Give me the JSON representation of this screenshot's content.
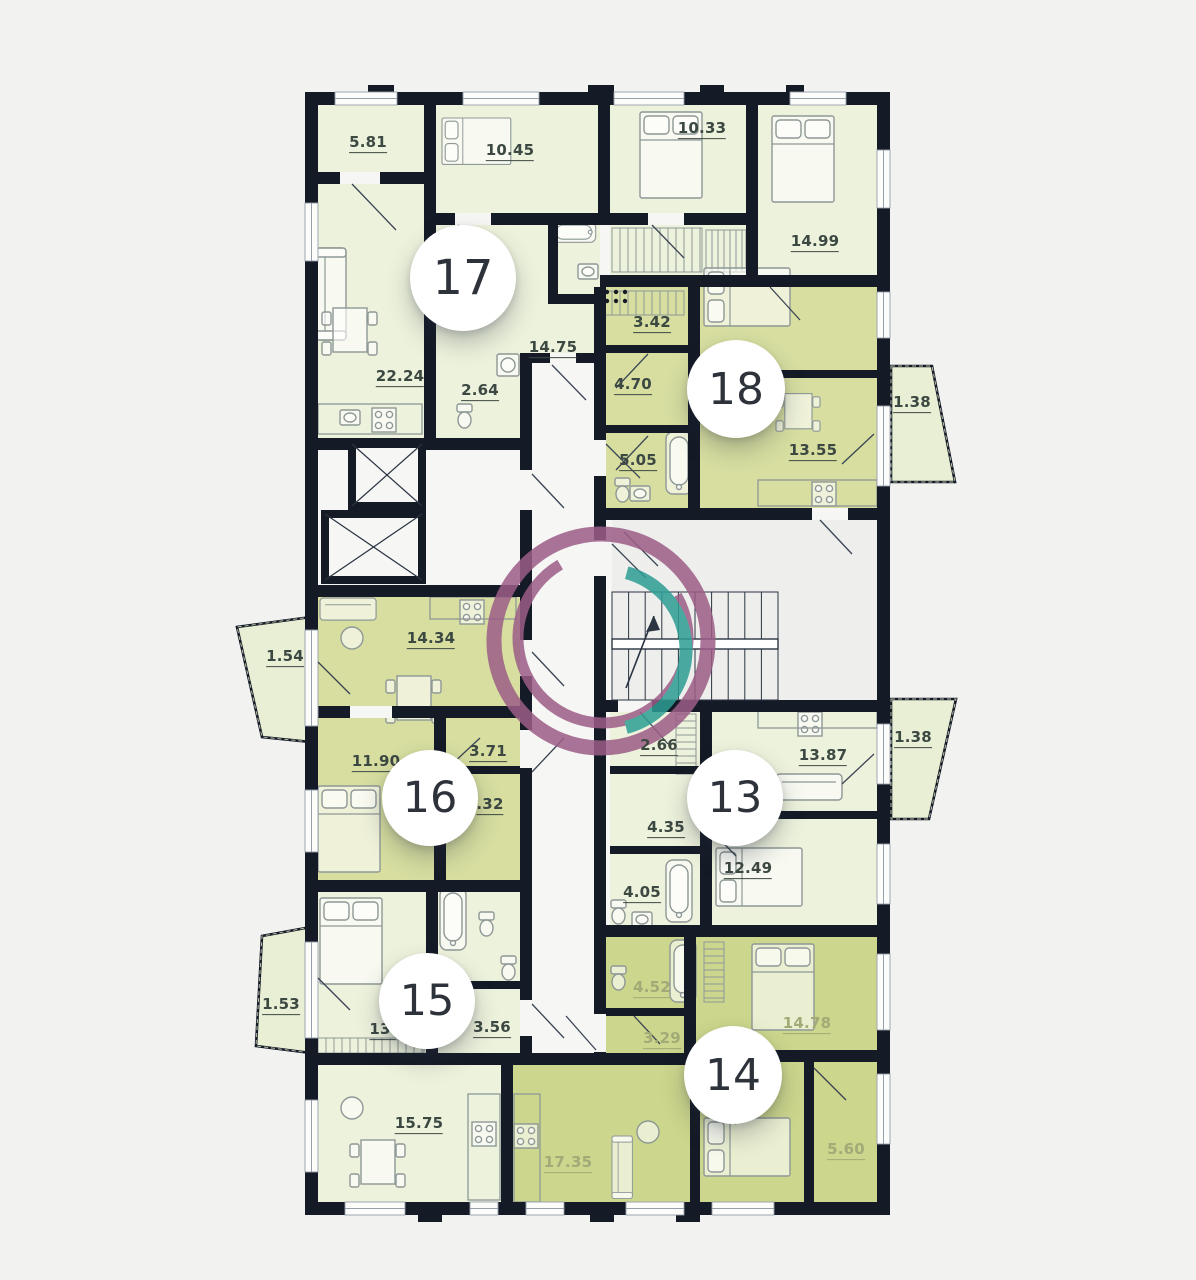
{
  "palette": {
    "background": "#f2f2f1",
    "wall": "#141a26",
    "room_light": "#edf2dc",
    "room_green": "#d7dea0",
    "room_green_deep": "#ccd68c",
    "balcony": "#e9efd5",
    "corridor": "#f6f6f4",
    "stair_core": "#eeeeec",
    "furniture_stroke": "#8e9896",
    "door_stroke": "#3a4454",
    "window_stroke": "#96a0ab",
    "label_dark": "#3c4842",
    "label_light": "#a2aa77",
    "circle_text": "#2e333b",
    "logo_purple": "#9c5d87",
    "logo_teal": "#2d9e94"
  },
  "floor_plan": {
    "apartments": [
      {
        "number": "17",
        "circle_x": 463,
        "circle_y": 278,
        "circle_size": 106
      },
      {
        "number": "18",
        "circle_x": 736,
        "circle_y": 389,
        "circle_size": 98
      },
      {
        "number": "16",
        "circle_x": 430,
        "circle_y": 798,
        "circle_size": 96
      },
      {
        "number": "13",
        "circle_x": 735,
        "circle_y": 798,
        "circle_size": 96
      },
      {
        "number": "15",
        "circle_x": 427,
        "circle_y": 1001,
        "circle_size": 96
      },
      {
        "number": "14",
        "circle_x": 733,
        "circle_y": 1075,
        "circle_size": 98
      }
    ],
    "area_labels": [
      {
        "apartment": "17",
        "text": "5.81",
        "x": 368,
        "y": 144,
        "tone": "dark"
      },
      {
        "apartment": "17",
        "text": "10.45",
        "x": 510,
        "y": 152,
        "tone": "dark"
      },
      {
        "apartment": "17",
        "text": "10.33",
        "x": 702,
        "y": 130,
        "tone": "dark"
      },
      {
        "apartment": "17",
        "text": "14.99",
        "x": 815,
        "y": 243,
        "tone": "dark"
      },
      {
        "apartment": "17",
        "text": "22.24",
        "x": 400,
        "y": 378,
        "tone": "dark"
      },
      {
        "apartment": "17",
        "text": "2.64",
        "x": 480,
        "y": 392,
        "tone": "dark"
      },
      {
        "apartment": "17",
        "text": "14.75",
        "x": 553,
        "y": 349,
        "tone": "dark"
      },
      {
        "apartment": "18",
        "text": "3.42",
        "x": 652,
        "y": 324,
        "tone": "dark"
      },
      {
        "apartment": "18",
        "text": "4.70",
        "x": 633,
        "y": 386,
        "tone": "dark"
      },
      {
        "apartment": "18",
        "text": "5.05",
        "x": 638,
        "y": 462,
        "tone": "dark"
      },
      {
        "apartment": "18",
        "text": "13.55",
        "x": 813,
        "y": 452,
        "tone": "dark"
      },
      {
        "apartment": "18",
        "text": "1.38",
        "x": 912,
        "y": 404,
        "tone": "dark"
      },
      {
        "apartment": "16",
        "text": "1.54",
        "x": 285,
        "y": 658,
        "tone": "dark"
      },
      {
        "apartment": "16",
        "text": "14.34",
        "x": 431,
        "y": 640,
        "tone": "dark"
      },
      {
        "apartment": "16",
        "text": "11.90",
        "x": 376,
        "y": 763,
        "tone": "dark"
      },
      {
        "apartment": "16",
        "text": "3.71",
        "x": 488,
        "y": 753,
        "tone": "dark"
      },
      {
        "apartment": "16",
        "text": ".32",
        "x": 490,
        "y": 806,
        "tone": "dark"
      },
      {
        "apartment": "13",
        "text": "2.66",
        "x": 659,
        "y": 747,
        "tone": "dark"
      },
      {
        "apartment": "13",
        "text": "13.87",
        "x": 823,
        "y": 757,
        "tone": "dark"
      },
      {
        "apartment": "13",
        "text": "4.35",
        "x": 666,
        "y": 829,
        "tone": "dark"
      },
      {
        "apartment": "13",
        "text": "4.05",
        "x": 642,
        "y": 894,
        "tone": "dark"
      },
      {
        "apartment": "13",
        "text": "12.49",
        "x": 748,
        "y": 870,
        "tone": "dark"
      },
      {
        "apartment": "13",
        "text": "1.38",
        "x": 913,
        "y": 739,
        "tone": "dark"
      },
      {
        "apartment": "15",
        "text": "1.53",
        "x": 281,
        "y": 1006,
        "tone": "dark"
      },
      {
        "apartment": "15",
        "text": "13.",
        "x": 383,
        "y": 1031,
        "tone": "dark"
      },
      {
        "apartment": "15",
        "text": "3.56",
        "x": 492,
        "y": 1029,
        "tone": "dark"
      },
      {
        "apartment": "15",
        "text": "15.75",
        "x": 419,
        "y": 1125,
        "tone": "dark"
      },
      {
        "apartment": "14",
        "text": "4.52",
        "x": 652,
        "y": 989,
        "tone": "light"
      },
      {
        "apartment": "14",
        "text": "3.29",
        "x": 662,
        "y": 1040,
        "tone": "light"
      },
      {
        "apartment": "14",
        "text": "14.78",
        "x": 807,
        "y": 1025,
        "tone": "light"
      },
      {
        "apartment": "14",
        "text": "5.60",
        "x": 846,
        "y": 1151,
        "tone": "light"
      },
      {
        "apartment": "14",
        "text": "17.35",
        "x": 568,
        "y": 1164,
        "tone": "light"
      }
    ]
  }
}
